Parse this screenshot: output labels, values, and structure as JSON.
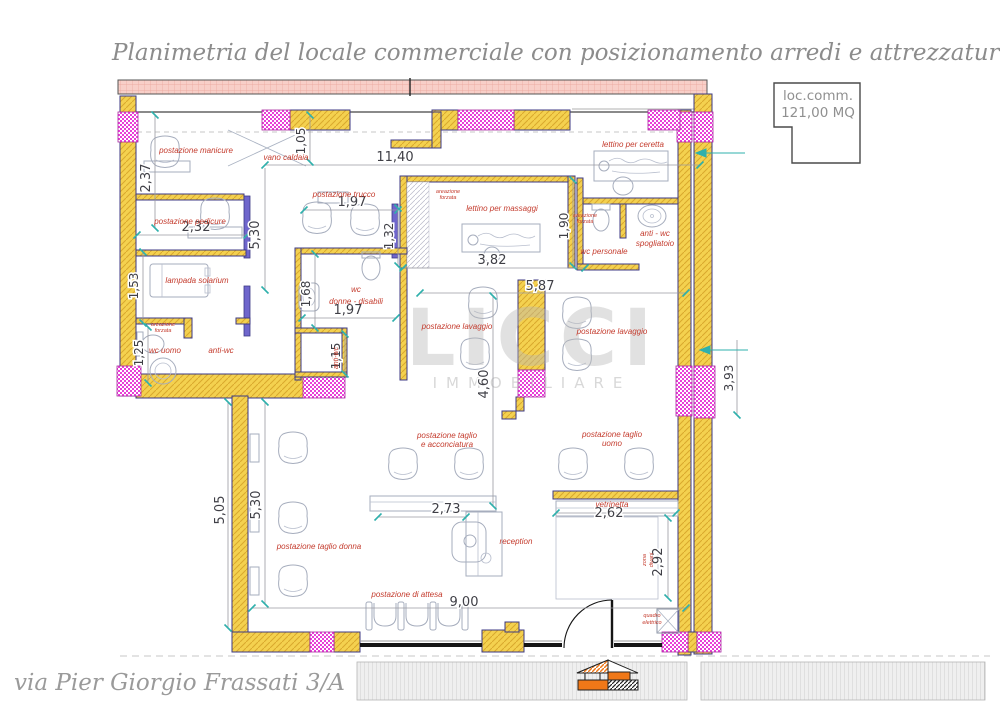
{
  "title": "Planimetria del locale commerciale con posizionamento arredi e attrezzature",
  "address": "via Pier Giorgio Frassati 3/A",
  "scale_label": "scala 1:50",
  "info_box": {
    "line1": "loc.comm.",
    "line2": "121,00 MQ"
  },
  "watermark": {
    "name": "LICCI",
    "subtitle": "IMMOBILIARE"
  },
  "rooms": {
    "manicure": "postazione manicure",
    "vano_caldaia": "vano caldaia",
    "pedicure": "postazione pedicure",
    "trucco": "postazione trucco",
    "solarium": "lampada solarium",
    "wc_uomo": "wc uomo",
    "anti_wc_left": "anti-wc",
    "massaggi": "lettino per massaggi",
    "ceretta": "lettino per ceretta",
    "wc_personale": "wc personale",
    "spogliatoio_line1": "anti - wc",
    "spogliatoio_line2": "spogliatoio",
    "wc_donne_line1": "wc",
    "wc_donne_line2": "donne - disabili",
    "anti_wc_mid": "anti-wc",
    "lavaggio_left": "postazione lavaggio",
    "lavaggio_right": "postazione lavaggio",
    "taglio_acc_line1": "postazione taglio",
    "taglio_acc_line2": "e acconciatura",
    "taglio_uomo_line1": "postazione taglio",
    "taglio_uomo_line2": "uomo",
    "taglio_donna": "postazione taglio donna",
    "reception": "reception",
    "attesa": "postazione di attesa",
    "vetrinetta": "vetrinetta",
    "zona_divani_line1": "zona",
    "zona_divani_line2": "divani",
    "quadro_line1": "quadro",
    "quadro_line2": "elettrico",
    "areazione_line1": "areazione",
    "areazione_line2": "forzata"
  },
  "dims": {
    "d1140": "11,40",
    "d237": "2,37",
    "d232": "2,32",
    "d153": "1,53",
    "d125": "1,25",
    "d530a": "5,30",
    "d530b": "5,30",
    "d505": "5,05",
    "d105": "1,05",
    "d197a": "1,97",
    "d132": "1,32",
    "d382": "3,82",
    "d190": "1,90",
    "d168": "1,68",
    "d197b": "1,97",
    "d115": "1,15",
    "d587": "5,87",
    "d460": "4,60",
    "d273": "2,73",
    "d262": "2,62",
    "d292": "2,92",
    "d900": "9,00",
    "d393": "3,93"
  },
  "colors": {
    "wall_yellow": "#f4d14f",
    "pier_magenta": "#e93fd8",
    "band_pink": "#f8cfc8",
    "label_red": "#c43b2d",
    "tick_teal": "#2fb0ac",
    "title_gray": "#8c8c8c"
  }
}
